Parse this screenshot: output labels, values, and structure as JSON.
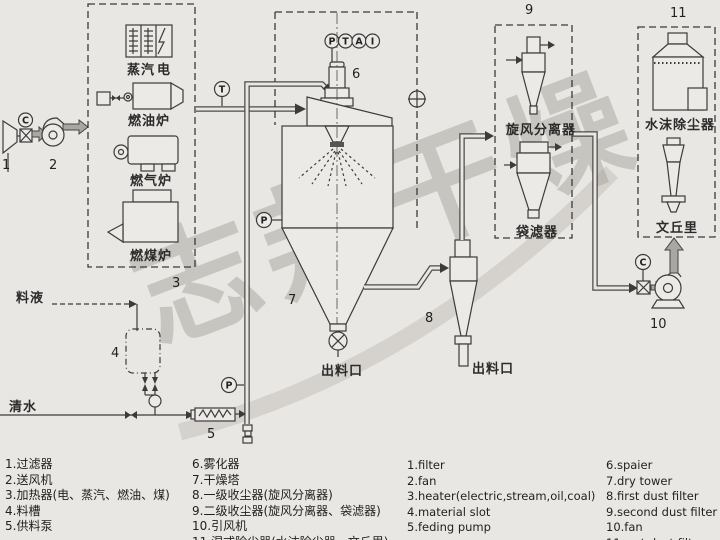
{
  "colors": {
    "background": "#e9e7e3",
    "ink": "#3b3b3b",
    "pipe": "#4b4b49",
    "gray_arrow": "#a9a7a1",
    "watermark": "#918f89"
  },
  "watermark_text": "志邦干燥",
  "tags": {
    "t1": "1",
    "t2": "2",
    "t3": "3",
    "t4": "4",
    "t5": "5",
    "t6": "6",
    "t7": "7",
    "t8": "8",
    "t9": "9",
    "t10": "10",
    "t11": "11"
  },
  "instruments": {
    "c_inlet": "C",
    "t_air": "T",
    "ptai": [
      "P",
      "T",
      "A",
      "I"
    ],
    "p_tower": "P",
    "p_feed": "P",
    "c_fan": "C"
  },
  "labels": {
    "steam": "蒸汽",
    "electric": "电",
    "oil_furnace": "燃油炉",
    "gas_furnace": "燃气炉",
    "coal_furnace": "燃煤炉",
    "feed_liquid": "料液",
    "clean_water": "清水",
    "tower_outlet": "出料口",
    "cyclone_outlet": "出料口",
    "cyclone_separator": "旋风分离器",
    "bag_filter": "袋滤器",
    "wet_scrubber": "水沫除尘器",
    "venturi": "文丘里"
  },
  "legend": {
    "cn_left": [
      "1.过滤器",
      "2.送风机",
      "3.加热器(电、蒸汽、燃油、煤)",
      "4.料槽",
      "5.供料泵"
    ],
    "cn_right": [
      "6.雾化器",
      "7.干燥塔",
      "8.一级收尘器(旋风分离器)",
      "9.二级收尘器(旋风分离器、袋滤器)",
      "10.引风机",
      "11.湿式除尘器(水沫除尘器、文丘里)"
    ],
    "en_left": [
      "1.filter",
      "2.fan",
      "3.heater(electric,stream,oil,coal)",
      "4.material slot",
      "5.feding pump"
    ],
    "en_right": [
      "6.spaier",
      "7.dry tower",
      "8.first dust filter",
      "9.second dust filter",
      "10.fan",
      "11.wet dust filter"
    ]
  }
}
